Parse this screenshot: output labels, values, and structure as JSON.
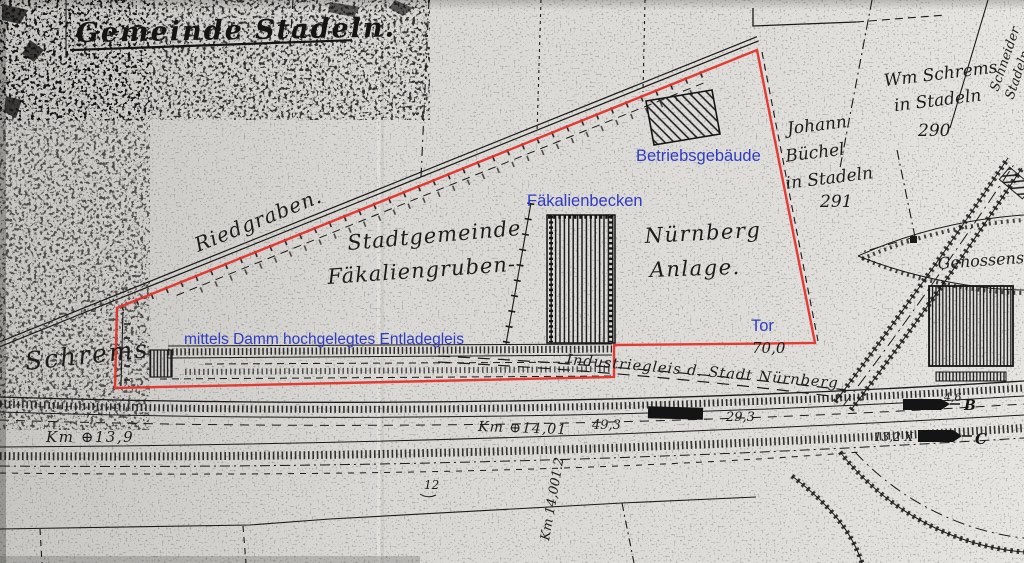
{
  "colors": {
    "paper_left": "#c8c6c2",
    "paper_mid": "#dbd9d5",
    "paper_right": "#e6e4e0",
    "ink": "#1b1a19",
    "boundary_red": "#e4322b",
    "annotation_blue": "#2f3bc3"
  },
  "title": {
    "text": "Gemeinde Stadeln."
  },
  "overlay": {
    "betriebsgebaeude": "Betriebsgebäude",
    "faekalienbecken": "Fäkalienbecken",
    "entladegleis": "mittels Damm hochgelegtes Entladegleis",
    "tor": "Tor"
  },
  "labels": {
    "riedgraben": "Riedgraben.",
    "stadtgemeinde_1": "Stadtgemeinde",
    "stadtgemeinde_2": "Fäkaliengruben-",
    "nuernberg_1": "Nürnberg",
    "nuernberg_2": "Anlage.",
    "owner_east_1": "Johann",
    "owner_east_2": "Büchel",
    "owner_east_3": "in Stadeln",
    "parcel_291": "291",
    "owner_ne_1": "Wm Schrems",
    "owner_ne_2": "in Stadeln",
    "parcel_290": "290",
    "owner_edge_1": "Schneider",
    "owner_edge_2": "Stadeln",
    "owner_west": "Schrems",
    "industriegleis": "Industriegleis d. Stadt Nürnberg",
    "dist_70": "70,0",
    "km_13_9": "Km ⊕13,9",
    "km_14_0": "Km ⊕14,01",
    "m_49_3": "49,3",
    "m_29_3": "29,3",
    "x_13_2": "13,2 X",
    "sig_b": "B",
    "sig_c": "C",
    "m_4_6": "4,6",
    "genossenschaft": "Genossensch-",
    "km_14001": "Km 14,001.2",
    "n_12": "12"
  }
}
